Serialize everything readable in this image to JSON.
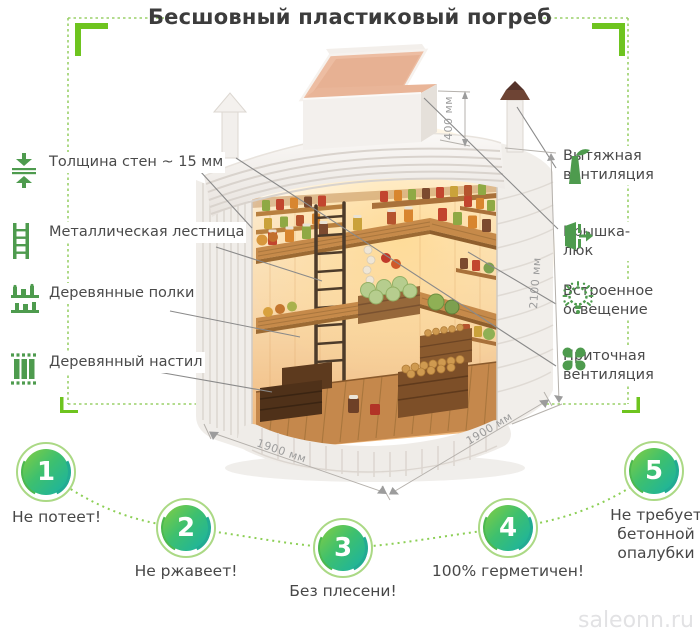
{
  "title": "Бесшовный пластиковый погреб",
  "watermark": "saleonn.ru",
  "features_left": [
    {
      "icon": "wall-thickness-icon",
      "label": "Толщина стен ~ 15 мм"
    },
    {
      "icon": "ladder-icon",
      "label": "Металлическая лестница"
    },
    {
      "icon": "shelves-icon",
      "label": "Деревянные полки"
    },
    {
      "icon": "planks-icon",
      "label": "Деревянный настил"
    }
  ],
  "features_right": [
    {
      "icon": "exhaust-vent-icon",
      "label": "Вытяжная вентиляция"
    },
    {
      "icon": "hatch-icon",
      "label": "Крышка-люк"
    },
    {
      "icon": "light-icon",
      "label": "Встроенное освещение"
    },
    {
      "icon": "supply-vent-icon",
      "label": "Приточная вентиляция"
    }
  ],
  "dimensions": {
    "hatch_height": "400 мм",
    "body_height": "2100 мм",
    "bottom_left": "1900 мм",
    "bottom_right": "1900 мм"
  },
  "benefits": [
    {
      "number": "1",
      "label": "Не потеет!"
    },
    {
      "number": "2",
      "label": "Не ржавеет!"
    },
    {
      "number": "3",
      "label": "Без плесени!"
    },
    {
      "number": "4",
      "label": "100% герметичен!"
    },
    {
      "number": "5",
      "label": "Не требует бетонной опалубки"
    }
  ],
  "colors": {
    "icon_green": "#4e9b4e",
    "bracket_green": "#6ec41f",
    "dotted_green": "#9ad069",
    "badge_gradient_start": "#84ce41",
    "badge_gradient_end": "#16b1a7",
    "text_dark": "#3c3c3c",
    "dimension_gray": "#9c9c9c"
  }
}
